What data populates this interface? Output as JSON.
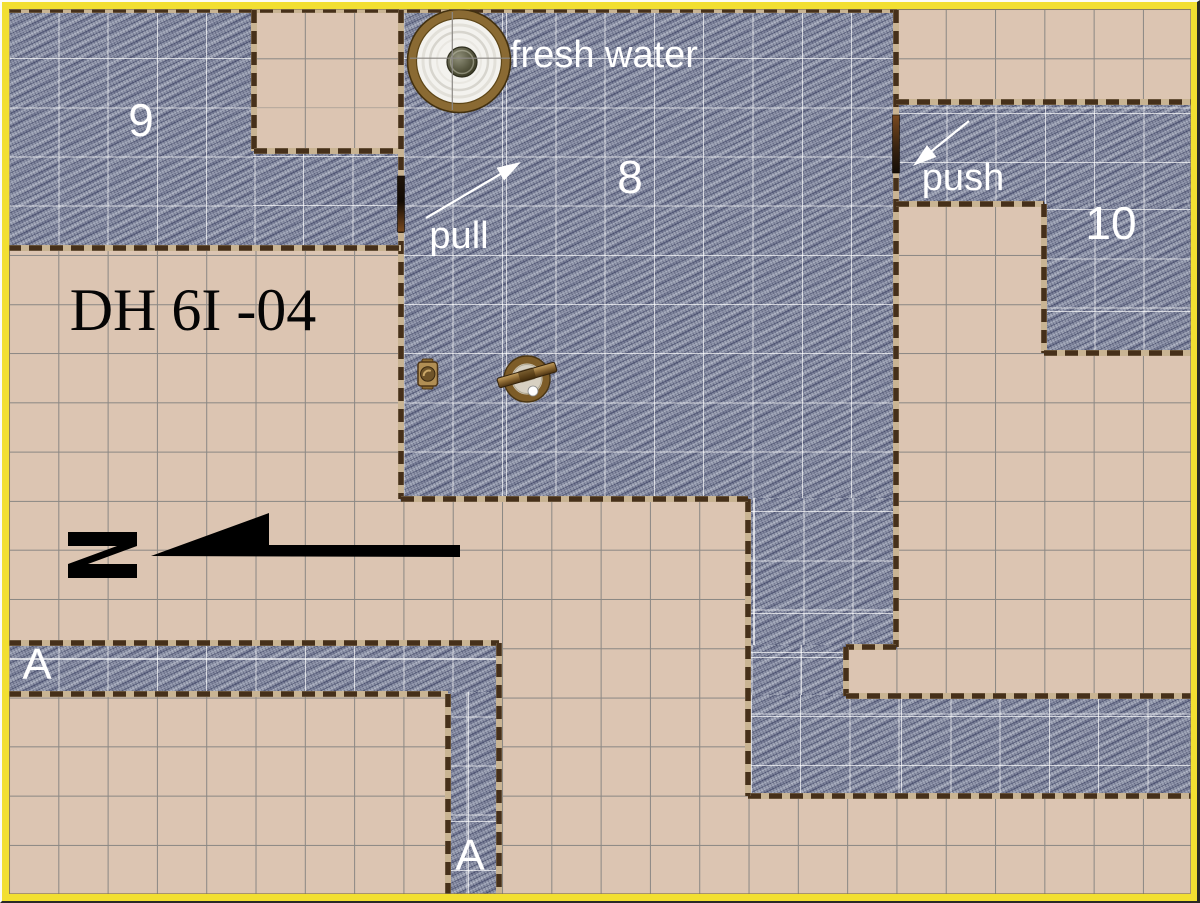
{
  "map": {
    "width": 1200,
    "height": 903,
    "grid": {
      "origin_x": 9,
      "origin_y": 9,
      "cell_w": 49.3,
      "cell_h": 49.17
    },
    "colors": {
      "floor_tan": "#dcc5b2",
      "grid_gray": "#8b8884",
      "stone_blue": "#9096aa",
      "wall_dash": "#46301a",
      "wall_base": "#c9b493",
      "frame_yellow": "#f2df31",
      "inner_grid_white": "#ffffff",
      "label_white": "#ffffff",
      "title_black": "#050505",
      "arrow_white": "#ffffff",
      "north_black": "#000000",
      "door_dark": "#1d1106",
      "door_brown": "#7a4a20",
      "well_ring_brown": "#8a6a33",
      "wheel_brown": "#7d5c28",
      "valve_brass": "#b18e54"
    },
    "regions": [
      {
        "x": 8,
        "y": 8,
        "w": 247,
        "h": 241
      },
      {
        "x": 253,
        "y": 151,
        "w": 147,
        "h": 98
      },
      {
        "x": 400,
        "y": 8,
        "w": 497,
        "h": 493
      },
      {
        "x": 748,
        "y": 498,
        "w": 149,
        "h": 151
      },
      {
        "x": 748,
        "y": 645,
        "w": 99,
        "h": 54
      },
      {
        "x": 746,
        "y": 695,
        "w": 446,
        "h": 101
      },
      {
        "x": 896,
        "y": 101,
        "w": 296,
        "h": 104
      },
      {
        "x": 1044,
        "y": 203,
        "w": 148,
        "h": 151
      },
      {
        "x": 8,
        "y": 644,
        "w": 492,
        "h": 50
      },
      {
        "x": 448,
        "y": 692,
        "w": 51,
        "h": 203
      }
    ],
    "walls": [
      [
        8,
        10,
        897,
        10
      ],
      [
        254,
        10,
        254,
        151
      ],
      [
        254,
        151,
        400,
        151
      ],
      [
        401,
        10,
        401,
        499
      ],
      [
        896,
        10,
        896,
        647
      ],
      [
        896,
        647,
        846,
        647
      ],
      [
        846,
        647,
        846,
        696
      ],
      [
        846,
        696,
        1192,
        696
      ],
      [
        748,
        796,
        1192,
        796
      ],
      [
        748,
        499,
        748,
        796
      ],
      [
        401,
        499,
        748,
        499
      ],
      [
        8,
        248,
        401,
        248
      ],
      [
        896,
        102,
        1192,
        102
      ],
      [
        896,
        204,
        1044,
        204
      ],
      [
        1044,
        204,
        1044,
        353
      ],
      [
        1044,
        353,
        1192,
        353
      ],
      [
        8,
        643,
        499,
        643
      ],
      [
        499,
        643,
        499,
        895
      ],
      [
        8,
        694,
        448,
        694
      ],
      [
        448,
        694,
        448,
        895
      ]
    ],
    "doors": [
      {
        "id": "door-pull",
        "x": 397.5,
        "y": 176,
        "w": 7,
        "h": 56,
        "grad": "door-grad-a"
      },
      {
        "id": "door-push",
        "x": 892.5,
        "y": 115,
        "w": 7,
        "h": 58,
        "grad": "door-grad-b"
      }
    ],
    "labels": [
      {
        "id": "room-9-label",
        "text": "9",
        "x": 141,
        "y": 121,
        "size": 46,
        "color": "#ffffff",
        "font": "sans",
        "align": "center"
      },
      {
        "id": "room-8-label",
        "text": "8",
        "x": 630,
        "y": 178,
        "size": 46,
        "color": "#ffffff",
        "font": "sans",
        "align": "center"
      },
      {
        "id": "room-10-label",
        "text": "10",
        "x": 1111,
        "y": 224,
        "size": 46,
        "color": "#ffffff",
        "font": "sans",
        "align": "center"
      },
      {
        "id": "corridor-a-label-west",
        "text": "A",
        "x": 37,
        "y": 666,
        "size": 44,
        "color": "#ffffff",
        "font": "sans",
        "align": "center"
      },
      {
        "id": "corridor-a-label-south",
        "text": "A",
        "x": 470,
        "y": 857,
        "size": 44,
        "color": "#ffffff",
        "font": "sans",
        "align": "center"
      },
      {
        "id": "fresh-water-label",
        "text": "fresh water",
        "x": 510,
        "y": 56,
        "size": 38,
        "color": "#ffffff",
        "font": "sans",
        "align": "left"
      },
      {
        "id": "pull-label",
        "text": "pull",
        "x": 459,
        "y": 237,
        "size": 38,
        "color": "#ffffff",
        "font": "sans",
        "align": "center"
      },
      {
        "id": "push-label",
        "text": "push",
        "x": 963,
        "y": 179,
        "size": 38,
        "color": "#ffffff",
        "font": "sans",
        "align": "center"
      },
      {
        "id": "map-title",
        "text": "DH 6I -04",
        "x": 193,
        "y": 311,
        "size": 60,
        "color": "#050505",
        "font": "serif",
        "align": "center"
      }
    ],
    "arrows": [
      {
        "id": "pull-arrow",
        "x1": 426,
        "y1": 218,
        "x2": 521,
        "y2": 162
      },
      {
        "id": "push-arrow",
        "x1": 969,
        "y1": 121,
        "x2": 913,
        "y2": 166
      }
    ],
    "north_arrow": {
      "n_glyph_points": "68,532 137,532 137,546 88,564 137,564 137,578 68,578 68,564 117,546 68,546",
      "bar_points": "151,556 269,513 269,545 460,545 460,557"
    },
    "icons": {
      "well": {
        "cx": 459,
        "cy": 61,
        "r": 47,
        "hole_r": 15,
        "grid_v_x": 452.3,
        "grid_h_y": 58.2
      },
      "wheel": {
        "cx": 527,
        "cy": 379,
        "r": 19,
        "beam_angle": -16,
        "beam_len": 60,
        "beam_th": 10,
        "ball_cx": 533,
        "ball_cy": 391,
        "ball_r": 5
      },
      "valve": {
        "x": 418,
        "y": 362,
        "w": 19.5,
        "h": 24
      }
    }
  }
}
